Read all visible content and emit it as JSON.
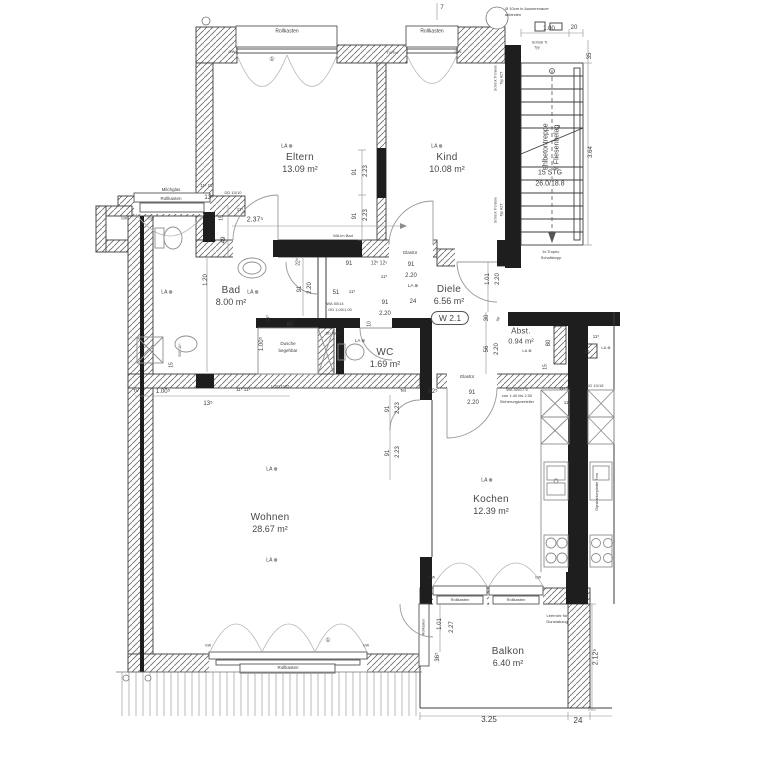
{
  "rooms": [
    {
      "name": "Eltern",
      "area": "13.09 m²",
      "cx": 300,
      "cy": 163
    },
    {
      "name": "Kind",
      "area": "10.08 m²",
      "cx": 447,
      "cy": 163
    },
    {
      "name": "Bad",
      "area": "8.00 m²",
      "cx": 231,
      "cy": 296
    },
    {
      "name": "Diele",
      "area": "6.56 m²",
      "cx": 449,
      "cy": 295
    },
    {
      "name": "WC",
      "area": "1.69 m²",
      "cx": 385,
      "cy": 358
    },
    {
      "name": "Abst.",
      "area": "0.94 m²",
      "cx": 521,
      "cy": 336
    },
    {
      "name": "Wohnen",
      "area": "28.67 m²",
      "cx": 270,
      "cy": 523
    },
    {
      "name": "Kochen",
      "area": "12.39 m²",
      "cx": 491,
      "cy": 505
    },
    {
      "name": "Balkon",
      "area": "6.40 m²",
      "cx": 508,
      "cy": 657
    }
  ],
  "badge": {
    "text": "W 2.1"
  },
  "stair": {
    "label_line1": "Stahlbetontreppe",
    "label_line2": "mit Fliesenbelag",
    "steps": "15 STG",
    "ratio": "26.0/18.8"
  },
  "colors": {
    "wall": "#1e1e1e",
    "line": "#3c3c3c",
    "lightline": "#9a9a9a",
    "text": "#3c3c3c"
  },
  "annotations": [
    {
      "t": "Rollkasten",
      "x": 287,
      "y": 32,
      "s": 5
    },
    {
      "t": "Rollkasten",
      "x": 432,
      "y": 32,
      "s": 5
    },
    {
      "t": "GW",
      "x": 232,
      "y": 52,
      "s": 4
    },
    {
      "t": "GW",
      "x": 458,
      "y": 52,
      "s": 4
    },
    {
      "t": "TV/Tel",
      "x": 392,
      "y": 53,
      "s": 4
    },
    {
      "t": "①",
      "x": 272,
      "y": 60,
      "s": 6
    },
    {
      "t": "7",
      "x": 442,
      "y": 8,
      "s": 6
    },
    {
      "t": "Ø 10cm in Aussenmauer",
      "x": 527,
      "y": 9,
      "s": 4
    },
    {
      "t": "anbinden",
      "x": 513,
      "y": 15,
      "s": 4
    },
    {
      "t": "1.00",
      "x": 549,
      "y": 29,
      "s": 6
    },
    {
      "t": "20",
      "x": 574,
      "y": 28,
      "s": 6
    },
    {
      "t": "Schöck Tr.",
      "x": 540,
      "y": 43,
      "s": 3.5
    },
    {
      "t": "Typ",
      "x": 537,
      "y": 48,
      "s": 3.5
    },
    {
      "t": "35",
      "x": 590,
      "y": 56,
      "r": -90,
      "s": 6
    },
    {
      "t": "3.64",
      "x": 591,
      "y": 152,
      "r": -90,
      "s": 6
    },
    {
      "t": "Schöck Tronsole",
      "x": 496,
      "y": 78,
      "r": -90,
      "s": 3.5
    },
    {
      "t": "Typ AZT",
      "x": 502,
      "y": 78,
      "r": -90,
      "s": 3.5
    },
    {
      "t": "Schöck Tronsole",
      "x": 496,
      "y": 210,
      "r": -90,
      "s": 3.5
    },
    {
      "t": "Typ AZT",
      "x": 502,
      "y": 210,
      "r": -90,
      "s": 3.5
    },
    {
      "t": "bi-Tropec",
      "x": 551,
      "y": 252,
      "s": 4
    },
    {
      "t": "Schallstopp",
      "x": 551,
      "y": 258,
      "s": 4
    },
    {
      "t": "91",
      "x": 355,
      "y": 172,
      "r": -90,
      "s": 6
    },
    {
      "t": "2.23",
      "x": 366,
      "y": 171,
      "r": -90,
      "s": 6
    },
    {
      "t": "91",
      "x": 355,
      "y": 216,
      "r": -90,
      "s": 6
    },
    {
      "t": "2.23",
      "x": 366,
      "y": 215,
      "r": -90,
      "s": 6
    },
    {
      "t": "2.37⁵",
      "x": 255,
      "y": 220,
      "s": 7
    },
    {
      "t": "13⁵",
      "x": 209,
      "y": 198,
      "s": 6
    },
    {
      "t": "DD 10/10",
      "x": 233,
      "y": 193,
      "s": 4
    },
    {
      "t": "11⁵",
      "x": 240,
      "y": 210,
      "s": 4.5
    },
    {
      "t": "15",
      "x": 222,
      "y": 218,
      "r": -90,
      "s": 5
    },
    {
      "t": "49",
      "x": 224,
      "y": 240,
      "r": -90,
      "s": 6
    },
    {
      "t": "11¹ 11¹",
      "x": 207,
      "y": 186,
      "s": 4.5
    },
    {
      "t": "WA im Bad",
      "x": 343,
      "y": 236,
      "s": 4
    },
    {
      "t": "Glastür",
      "x": 410,
      "y": 253,
      "s": 4.5
    },
    {
      "t": "Milchglas",
      "x": 171,
      "y": 190,
      "s": 4.5
    },
    {
      "t": "Rollkasten",
      "x": 171,
      "y": 199,
      "s": 4.5
    },
    {
      "t": "GW",
      "x": 124,
      "y": 219,
      "s": 3.5
    },
    {
      "t": "GW",
      "x": 151,
      "y": 219,
      "s": 3.5
    },
    {
      "t": "1.20",
      "x": 206,
      "y": 280,
      "r": -90,
      "s": 6
    },
    {
      "t": "22⁰",
      "x": 299,
      "y": 262,
      "r": -90,
      "s": 5
    },
    {
      "t": "91",
      "x": 300,
      "y": 289,
      "r": -90,
      "s": 6
    },
    {
      "t": "2.20",
      "x": 310,
      "y": 288,
      "r": -90,
      "s": 6
    },
    {
      "t": "91",
      "x": 349,
      "y": 264,
      "s": 6
    },
    {
      "t": "12⁰ 12⁵",
      "x": 379,
      "y": 264,
      "s": 5
    },
    {
      "t": "11⁵",
      "x": 384,
      "y": 277,
      "s": 4.5
    },
    {
      "t": "91",
      "x": 411,
      "y": 265,
      "s": 6
    },
    {
      "t": "2.20",
      "x": 411,
      "y": 276,
      "s": 6
    },
    {
      "t": "51",
      "x": 336,
      "y": 293,
      "s": 6
    },
    {
      "t": "11⁵",
      "x": 352,
      "y": 292,
      "s": 4.5
    },
    {
      "t": "WA 50/14",
      "x": 335,
      "y": 304,
      "s": 4
    },
    {
      "t": "OD 1.00/1.00",
      "x": 340,
      "y": 310,
      "s": 4
    },
    {
      "t": "91",
      "x": 385,
      "y": 303,
      "s": 6
    },
    {
      "t": "2.20",
      "x": 385,
      "y": 314,
      "s": 6
    },
    {
      "t": "24",
      "x": 413,
      "y": 302,
      "s": 6
    },
    {
      "t": "10",
      "x": 370,
      "y": 324,
      "r": -90,
      "s": 5
    },
    {
      "t": "80",
      "x": 290,
      "y": 325,
      "s": 6
    },
    {
      "t": "11⁵",
      "x": 268,
      "y": 318,
      "r": -90,
      "s": 4.5
    },
    {
      "t": "1.00⁵",
      "x": 262,
      "y": 344,
      "r": -90,
      "s": 6
    },
    {
      "t": "Dusche",
      "x": 288,
      "y": 344,
      "s": 4.5
    },
    {
      "t": "begehbar",
      "x": 288,
      "y": 351,
      "s": 4.5
    },
    {
      "t": "DD 10/10",
      "x": 333,
      "y": 334,
      "s": 3.5
    },
    {
      "t": "50⁵-11⁵",
      "x": 180,
      "y": 350,
      "r": -90,
      "s": 4
    },
    {
      "t": "15",
      "x": 172,
      "y": 365,
      "r": -90,
      "s": 5
    },
    {
      "t": "1.01",
      "x": 488,
      "y": 279,
      "r": -90,
      "s": 6
    },
    {
      "t": "2.20",
      "x": 498,
      "y": 279,
      "r": -90,
      "s": 6
    },
    {
      "t": "30",
      "x": 487,
      "y": 318,
      "r": -90,
      "s": 6
    },
    {
      "t": "Sp",
      "x": 498,
      "y": 319,
      "r": -90,
      "s": 4
    },
    {
      "t": "56",
      "x": 487,
      "y": 349,
      "r": -90,
      "s": 6
    },
    {
      "t": "2.20",
      "x": 497,
      "y": 349,
      "r": -90,
      "s": 6
    },
    {
      "t": "80",
      "x": 549,
      "y": 343,
      "r": -90,
      "s": 6
    },
    {
      "t": "15",
      "x": 546,
      "y": 367,
      "r": -90,
      "s": 5
    },
    {
      "t": "11⁵",
      "x": 596,
      "y": 337,
      "s": 4.5
    },
    {
      "t": "LA ⊗",
      "x": 606,
      "y": 348,
      "s": 4
    },
    {
      "t": "15",
      "x": 587,
      "y": 352,
      "s": 4.5
    },
    {
      "t": "Glastür",
      "x": 467,
      "y": 377,
      "s": 4.5
    },
    {
      "t": "Tel",
      "x": 403,
      "y": 391,
      "s": 4.5
    },
    {
      "t": "62⁵",
      "x": 433,
      "y": 392,
      "s": 6
    },
    {
      "t": "91",
      "x": 472,
      "y": 393,
      "s": 6
    },
    {
      "t": "2.20",
      "x": 473,
      "y": 403,
      "s": 6
    },
    {
      "t": "WA 40x17.5",
      "x": 517,
      "y": 390,
      "s": 4
    },
    {
      "t": "von 1.40 bis 2.00",
      "x": 517,
      "y": 396,
      "s": 4
    },
    {
      "t": "Sicherungsverteiler",
      "x": 517,
      "y": 402,
      "s": 4
    },
    {
      "t": "11⁵ 3⁵",
      "x": 565,
      "y": 389,
      "s": 4.5
    },
    {
      "t": "11⁵",
      "x": 567,
      "y": 403,
      "s": 4.5
    },
    {
      "t": "DD 10/15",
      "x": 595,
      "y": 386,
      "s": 4
    },
    {
      "t": "TV",
      "x": 136,
      "y": 391,
      "s": 4.5
    },
    {
      "t": "1.00⁵",
      "x": 163,
      "y": 392,
      "s": 6
    },
    {
      "t": "11⁵ 11¹",
      "x": 243,
      "y": 390,
      "s": 4.5
    },
    {
      "t": "1¹ DD 10/15",
      "x": 280,
      "y": 387,
      "s": 3.5
    },
    {
      "t": "13⁵",
      "x": 208,
      "y": 404,
      "s": 6
    },
    {
      "t": "91",
      "x": 388,
      "y": 409,
      "r": -90,
      "s": 6
    },
    {
      "t": "2.23",
      "x": 398,
      "y": 408,
      "r": -90,
      "s": 6
    },
    {
      "t": "91",
      "x": 388,
      "y": 453,
      "r": -90,
      "s": 6
    },
    {
      "t": "2.23",
      "x": 398,
      "y": 452,
      "r": -90,
      "s": 6
    },
    {
      "t": "Gipskartonplatte 7cm",
      "x": 597,
      "y": 492,
      "r": -90,
      "s": 4
    },
    {
      "t": "GW",
      "x": 432,
      "y": 578,
      "s": 3.5
    },
    {
      "t": "GW",
      "x": 538,
      "y": 578,
      "s": 3.5
    },
    {
      "t": "Rollkasten",
      "x": 460,
      "y": 600,
      "s": 4
    },
    {
      "t": "Rollkasten",
      "x": 516,
      "y": 600,
      "s": 4
    },
    {
      "t": "Rollkasten",
      "x": 424,
      "y": 627,
      "r": -90,
      "s": 3.5
    },
    {
      "t": "Leerrohr für",
      "x": 557,
      "y": 616,
      "s": 4
    },
    {
      "t": "Dunstabzug",
      "x": 557,
      "y": 622,
      "s": 4
    },
    {
      "t": "1.01",
      "x": 440,
      "y": 624,
      "r": -90,
      "s": 6
    },
    {
      "t": "2.27",
      "x": 452,
      "y": 627,
      "r": -90,
      "s": 6
    },
    {
      "t": "36⁵",
      "x": 438,
      "y": 657,
      "r": -90,
      "s": 6
    },
    {
      "t": "3.25",
      "x": 489,
      "y": 720,
      "s": 8
    },
    {
      "t": "24",
      "x": 578,
      "y": 721,
      "s": 8
    },
    {
      "t": "2.12⁵",
      "x": 596,
      "y": 657,
      "r": -90,
      "s": 7
    },
    {
      "t": "GW",
      "x": 208,
      "y": 646,
      "s": 3.5
    },
    {
      "t": "GW",
      "x": 366,
      "y": 646,
      "s": 3.5
    },
    {
      "t": "①",
      "x": 328,
      "y": 641,
      "s": 6
    },
    {
      "t": "Rollkasten",
      "x": 288,
      "y": 668,
      "s": 4.5
    },
    {
      "t": "LA ⊗",
      "x": 287,
      "y": 147,
      "s": 5
    },
    {
      "t": "LA ⊗",
      "x": 437,
      "y": 147,
      "s": 5
    },
    {
      "t": "LA ⊗",
      "x": 167,
      "y": 293,
      "s": 5
    },
    {
      "t": "LA ⊗",
      "x": 253,
      "y": 293,
      "s": 5
    },
    {
      "t": "LA ⊗",
      "x": 360,
      "y": 341,
      "s": 4.5
    },
    {
      "t": "LA ⊗",
      "x": 413,
      "y": 286,
      "s": 4.5
    },
    {
      "t": "LA ⊗",
      "x": 527,
      "y": 351,
      "s": 4
    },
    {
      "t": "LA ⊗",
      "x": 272,
      "y": 470,
      "s": 5
    },
    {
      "t": "LA ⊗",
      "x": 272,
      "y": 561,
      "s": 5
    },
    {
      "t": "LA ⊗",
      "x": 487,
      "y": 481,
      "s": 5
    }
  ]
}
